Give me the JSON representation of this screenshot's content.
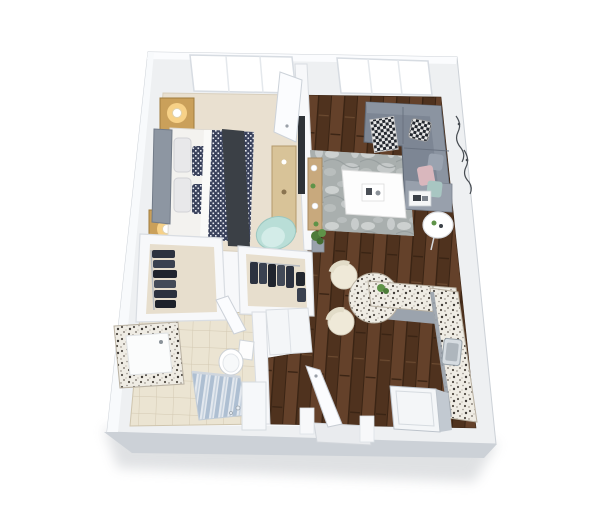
{
  "scene": {
    "kind": "3d-isometric-floor-plan-render",
    "units_text_visible": false,
    "canvas": {
      "width": 600,
      "height": 510
    }
  },
  "palette": {
    "background": "#ffffff",
    "wall_plate": "#eef0f2",
    "wall_top": "#fbfcfe",
    "wall_face": "#ccd1d7",
    "wall_edge": "#d8dce1",
    "inner_wall": "#f7f8fa",
    "carpet": "#e9e0d0",
    "closet_carpet": "#e7decd",
    "tile_line": "#d3c9b2",
    "wood_base": "#5b3a27",
    "rug": "#a9afae",
    "sofa": "#7d8694",
    "sofa_back": "#8b94a1",
    "chaise": "#98a0ac",
    "pillow_pink": "#d9b7bd",
    "pillow_teal": "#a8c6c2",
    "pillow_gray": "#9aa3b0",
    "mattress": "#f3f2ef",
    "headboard": "#8d96a2",
    "duvet_navy": "#3a425c",
    "throw_dark": "#3b4046",
    "nightstand_gold": "#caa05a",
    "lamp_glow": "#ffd98f",
    "dresser_wood": "#d8c398",
    "console_wood": "#c8a97d",
    "tv_screen": "#2e3237",
    "accent_chair": "#b9ded7",
    "stool_cream": "#efe9d8",
    "cabinet_gray": "#9ba3ad",
    "steel": "#c2c9d1",
    "fridge_top": "#f4f6f8",
    "fixture_white": "#fdfdfd",
    "door_leaf": "#fbfcfe",
    "curtain_blue": "#aebfd2",
    "plant_green": "#4d7c3a",
    "art_line": "#474c52",
    "shadow": "#b9bdc2"
  },
  "inventory": {
    "bedroom": {
      "floor": "carpet",
      "items": [
        "queen-bed",
        "gray-headboard",
        "white-pillows",
        "patterned-accent-pillows",
        "navy-check-duvet",
        "charcoal-throw",
        "nightstand-upper",
        "nightstand-lower",
        "lit-table-lamp-upper",
        "lit-table-lamp-lower",
        "wood-dresser",
        "wall-mounted-tv",
        "teal-accent-chair",
        "window"
      ]
    },
    "living_room": {
      "floor": "hardwood",
      "items": [
        "gray-sectional-sofa",
        "houndstooth-throw",
        "sequin-pillow",
        "pink-pillow",
        "teal-pillow",
        "gray-pillow",
        "marble-area-rug",
        "white-coffee-table",
        "decor-tray",
        "wood-console-table",
        "round-side-table",
        "floor-plant",
        "branch-wall-art",
        "window"
      ]
    },
    "bathroom": {
      "floor": "tile",
      "items": [
        "granite-vanity-with-sink",
        "toilet",
        "shower-with-striped-curtain",
        "linen-cabinet",
        "bathroom-door"
      ]
    },
    "kitchen": {
      "floor": "hardwood",
      "items": [
        "l-shaped-granite-counter",
        "rounded-breakfast-bar",
        "bar-stool-1",
        "bar-stool-2",
        "counter-plant",
        "stainless-sink",
        "refrigerator"
      ]
    },
    "entry": {
      "items": [
        "open-entry-door",
        "threshold"
      ]
    },
    "closets": {
      "items": [
        "walk-in-closet-left",
        "closet-middle",
        "hanging-clothes-left",
        "hanging-clothes-middle"
      ]
    },
    "doors_count": 4,
    "windows_count": 2,
    "bar_stools_count": 2,
    "lamps_count": 2
  }
}
